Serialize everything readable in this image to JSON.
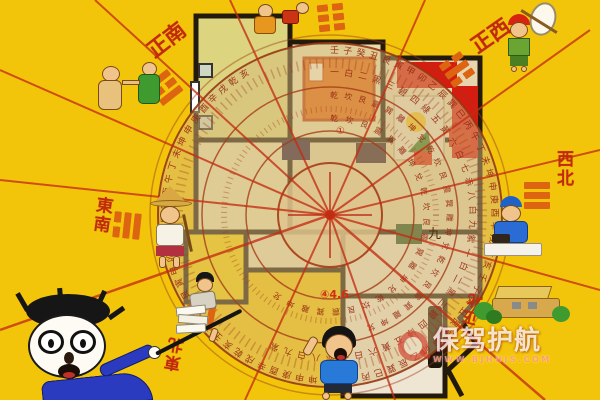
{
  "colors": {
    "background": "#f3c50a",
    "accent_red": "#c2290f",
    "trigram_orange": "#dd6410",
    "compass_tan": "#d8bc80",
    "wall": "#241a0c",
    "kitchen_yellow": "#f2cf06",
    "bed_orange": "#e2660e",
    "sofa_red": "#d41c10"
  },
  "directions": [
    {
      "label": "正南",
      "position": "top-left"
    },
    {
      "label": "正西",
      "position": "top-right"
    },
    {
      "label": "東南",
      "position": "left"
    },
    {
      "label": "西北",
      "position": "right"
    },
    {
      "label": "東北",
      "position": "bottom-left"
    },
    {
      "label": "正北",
      "position": "bottom-right"
    }
  ],
  "compass": {
    "ring_text_outer": "壬子癸丑艮寅甲卯乙辰巽巳丙午丁未坤申庚酉辛戌乾亥壬子癸丑艮寅甲卯乙辰巽巳丙午丁未坤申庚酉辛戌乾亥壬子癸丑艮寅甲卯乙辰巽巳丙午丁未坤申庚酉辛戌乾亥",
    "ring_text_middle": "一白二黑三碧四綠五黃六白七赤八白九紫一白二黑三碧四綠五黃六白七赤八白九紫",
    "ring_text_inner": "乾坎艮震巽離坤兌乾坎艮震巽離坤兌乾坎艮震巽離坤兌",
    "annotations": {
      "num_46": "④4.6",
      "nine": "九",
      "one": "①"
    }
  },
  "watermark": {
    "brand": "保驾护航",
    "url": "WWW.BJHHJS.COM"
  },
  "illustrations": [
    {
      "name": "quarreling-pair",
      "description": "two small cartoon figures quarreling at top left"
    },
    {
      "name": "figures-with-red-bag",
      "description": "cartoon figures clipped at the top edge"
    },
    {
      "name": "runaway-boy",
      "description": "boy with red cap carrying a white bundle on a stick"
    },
    {
      "name": "farmer",
      "description": "farmer wearing a straw hat on the left side"
    },
    {
      "name": "worker-at-table",
      "description": "worker in blue at a small table on the right"
    },
    {
      "name": "professor",
      "description": "professor with glasses pointing a stick at the floor plan"
    },
    {
      "name": "person-with-books",
      "description": "person tumbling with a stack of books"
    },
    {
      "name": "running-boy",
      "description": "boy in a blue shirt running at the bottom center"
    },
    {
      "name": "house-cart",
      "description": "small house with green bushes at bottom right"
    }
  ]
}
